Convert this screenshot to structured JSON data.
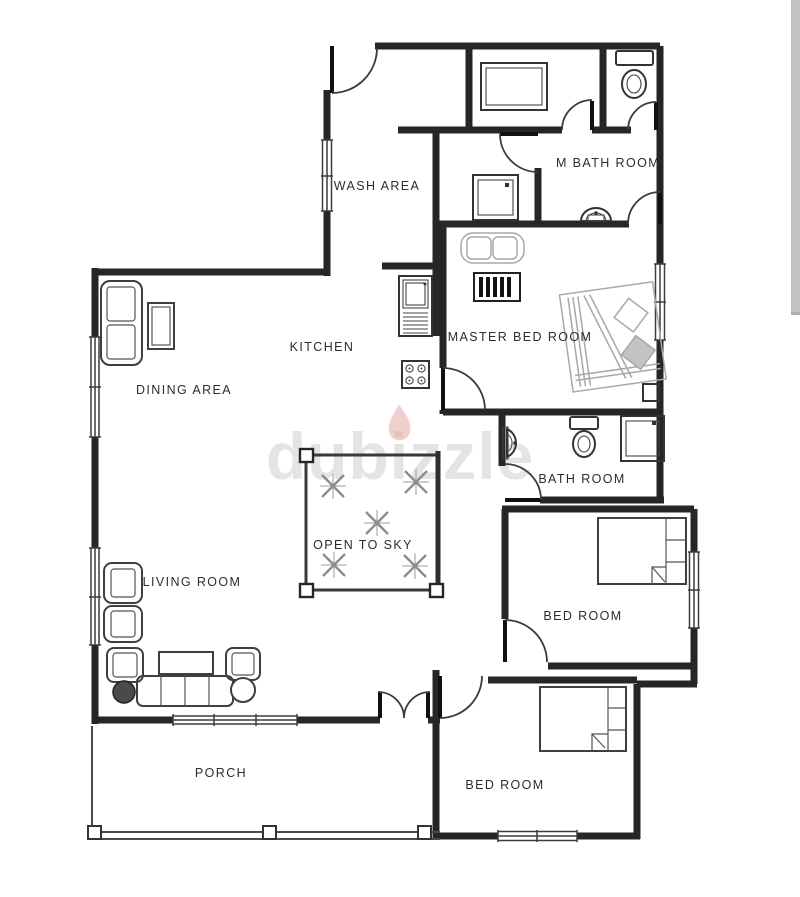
{
  "watermark": {
    "text": "dubizzle"
  },
  "rooms": {
    "wash_area": "WASH AREA",
    "m_bath": "M BATH ROOM",
    "kitchen": "KITCHEN",
    "master_bed": "MASTER BED ROOM",
    "dining": "DINING AREA",
    "bath": "BATH ROOM",
    "open_sky": "OPEN TO SKY",
    "living": "LIVING ROOM",
    "bed_mid": "BED ROOM",
    "bed_bottom": "BED ROOM",
    "porch": "PORCH"
  },
  "colors": {
    "wall": "#262626",
    "watermark_gray": "#cbcbcb",
    "flame_pink": "#e2a9a4",
    "scrollbar": "#c2c2c2"
  }
}
